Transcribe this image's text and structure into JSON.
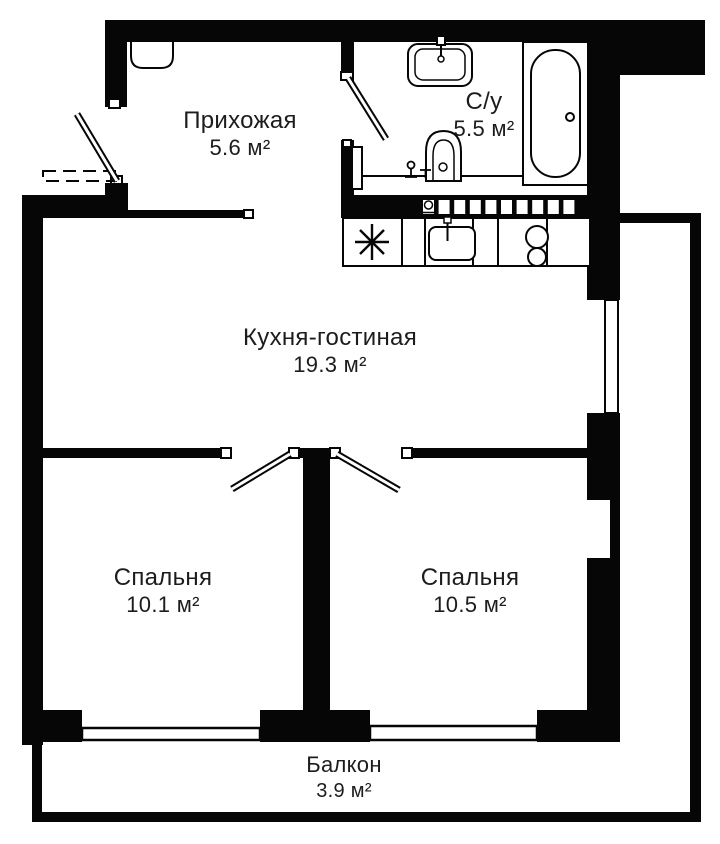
{
  "plan": {
    "type": "apartment-floor-plan",
    "rooms": [
      {
        "key": "hallway",
        "name": "Прихожая",
        "area": "5.6 м²"
      },
      {
        "key": "bathroom",
        "name": "С/у",
        "area": "5.5 м²"
      },
      {
        "key": "kitchen_living",
        "name": "Кухня-гостиная",
        "area": "19.3 м²"
      },
      {
        "key": "bedroom_left",
        "name": "Спальня",
        "area": "10.1 м²"
      },
      {
        "key": "bedroom_right",
        "name": "Спальня",
        "area": "10.5 м²"
      },
      {
        "key": "balcony",
        "name": "Балкон",
        "area": "3.9 м²"
      }
    ],
    "colors": {
      "wall": "#060606",
      "background": "#ffffff",
      "line": "#111111"
    },
    "fixtures": [
      "bathtub",
      "bathroom-sink",
      "toilet",
      "towel-radiator",
      "kitchen-sink",
      "hob",
      "vent-block",
      "wardrobe",
      "entry-door",
      "bathroom-door",
      "bedroom-left-door",
      "bedroom-right-door",
      "window-kitchen",
      "window-bedroom-left",
      "window-bedroom-right"
    ]
  }
}
